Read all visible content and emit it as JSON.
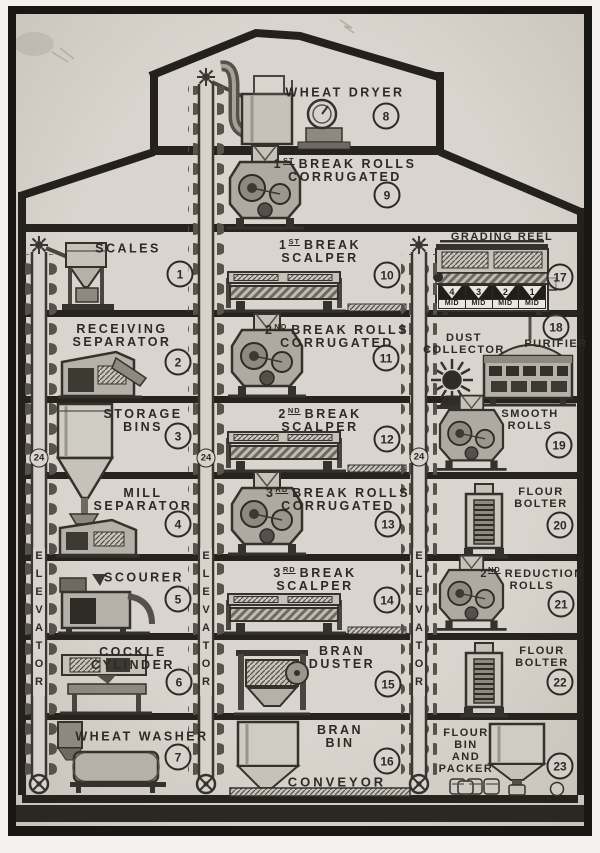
{
  "palette": {
    "paper": "#d8d4cd",
    "ink": "#2d2a25",
    "wall": "#24211d",
    "frame": "#191714"
  },
  "stations": {
    "scales": {
      "line1": "SCALES",
      "badge": "1"
    },
    "receiving_separator": {
      "line1": "RECEIVING",
      "line2": "SEPARATOR",
      "badge": "2"
    },
    "storage_bins": {
      "line1": "STORAGE",
      "line2": "BINS",
      "badge": "3"
    },
    "mill_separator": {
      "line1": "MILL",
      "line2": "SEPARATOR",
      "badge": "4"
    },
    "scourer": {
      "line1": "SCOURER",
      "badge": "5"
    },
    "cockle_cylinder": {
      "line1": "COCKLE",
      "line2": "CYLINDER",
      "badge": "6"
    },
    "wheat_washer": {
      "line1": "WHEAT WASHER",
      "badge": "7"
    },
    "wheat_dryer": {
      "line1": "WHEAT DRYER",
      "badge": "8"
    },
    "break1_rolls": {
      "ord": "1",
      "sup": "ST",
      "rest": "BREAK ROLLS",
      "line2": "CORRUGATED",
      "badge": "9"
    },
    "break1_scalper": {
      "ord": "1",
      "sup": "ST",
      "rest": "BREAK",
      "line2": "SCALPER",
      "badge": "10"
    },
    "break2_rolls": {
      "ord": "2",
      "sup": "ND",
      "rest": "BREAK ROLLS",
      "line2": "CORRUGATED",
      "badge": "11"
    },
    "break2_scalper": {
      "ord": "2",
      "sup": "ND",
      "rest": "BREAK",
      "line2": "SCALPER",
      "badge": "12"
    },
    "break3_rolls": {
      "ord": "3",
      "sup": "RD",
      "rest": "BREAK ROLLS",
      "line2": "CORRUGATED",
      "badge": "13"
    },
    "break3_scalper": {
      "ord": "3",
      "sup": "RD",
      "rest": "BREAK",
      "line2": "SCALPER",
      "badge": "14"
    },
    "bran_duster": {
      "line1": "BRAN",
      "line2": "DUSTER",
      "badge": "15"
    },
    "bran_bin": {
      "line1": "BRAN",
      "line2": "BIN",
      "badge": "16"
    },
    "grading_reel": {
      "line1": "GRADING REEL",
      "badge": "17",
      "hoppers": [
        {
          "num": "4",
          "sub": "MID"
        },
        {
          "num": "3",
          "sub": "MID"
        },
        {
          "num": "2",
          "sub": "MID"
        },
        {
          "num": "1",
          "sub": "MID"
        }
      ]
    },
    "purifier": {
      "line1": "PURIFIER",
      "badge": "18"
    },
    "dust_collector": {
      "line1": "DUST",
      "line2": "COLLECTOR"
    },
    "smooth_rolls": {
      "line1": "SMOOTH",
      "line2": "ROLLS",
      "badge": "19"
    },
    "flour_bolter_1": {
      "line1": "FLOUR",
      "line2": "BOLTER",
      "badge": "20"
    },
    "reduction2_rolls": {
      "ord": "2",
      "sup": "ND",
      "rest": "REDUCTION",
      "line2": "ROLLS",
      "badge": "21"
    },
    "flour_bolter_2": {
      "line1": "FLOUR",
      "line2": "BOLTER",
      "badge": "22"
    },
    "flour_bin_packer": {
      "line1": "FLOUR",
      "line2": "BIN",
      "line3": "AND",
      "line4": "PACKER",
      "badge": "23"
    }
  },
  "elevator": {
    "label": "ELEVATOR",
    "badge": "24"
  },
  "conveyor": {
    "label": "CONVEYOR"
  }
}
